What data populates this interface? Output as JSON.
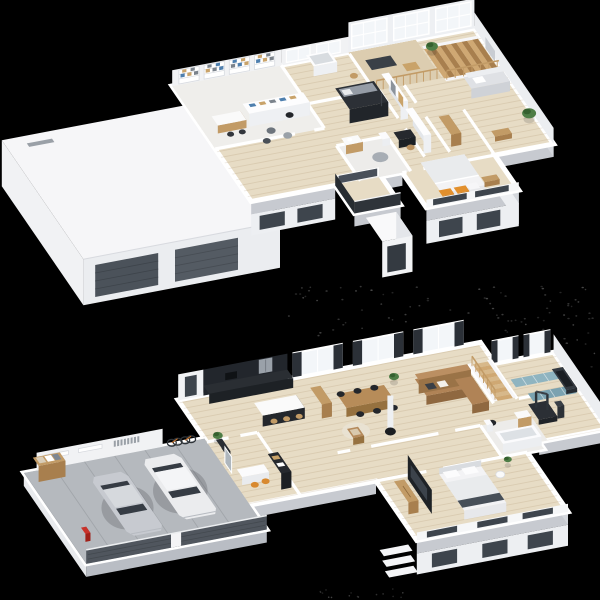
{
  "scene": {
    "title": "3D dollhouse floor plans of a two-storey house with garage, rendered on black",
    "background": "#000000",
    "floors": [
      {
        "name": "upper-floor",
        "rooms": [
          "library-playroom",
          "nursery",
          "kids-bunk-room",
          "bathroom",
          "walk-in-closet",
          "mezzanine-corridor",
          "staircase",
          "landing-lounge",
          "master-bedroom",
          "balcony"
        ],
        "exterior": [
          "garage-flat-roof",
          "double-height-window-wall",
          "porch-below"
        ],
        "objects": [
          "wall-bookshelves",
          "shelf-island",
          "play-desk",
          "floor-poufs",
          "bunk-bed",
          "crib",
          "vanity",
          "round-rug",
          "wardrobes",
          "double-bed-orange-pillows",
          "dresser",
          "grey-sofa",
          "potted-plants",
          "wood-railing",
          "wood-stairs",
          "dark-balcony-railing"
        ]
      },
      {
        "name": "ground-floor",
        "rooms": [
          "garage",
          "entry-hall",
          "home-office-nook",
          "kitchen",
          "dining-area",
          "living-room",
          "staircase",
          "home-gym",
          "bathroom",
          "bedroom"
        ],
        "objects": [
          "white-suv",
          "silver-car",
          "storage-shelf-boxes",
          "wall-bikes",
          "red-vacuum",
          "black-kitchen-wall",
          "kitchen-island-stools",
          "wood-shelf",
          "dining-table-six-black-chairs",
          "armchair",
          "round-rug",
          "white-stove-pipe",
          "caramel-corner-sofa",
          "wood-stairs",
          "exercise-machine",
          "treadmill",
          "blue-gym-mats",
          "bathtub",
          "vanity",
          "double-bed",
          "wood-dresser",
          "dark-tv-panel",
          "porch-steps"
        ]
      }
    ],
    "palette": {
      "bg": "#000000",
      "dot": "#4c4c4c",
      "roofTop": "#f6f6f8",
      "wallWhite": "#ffffff",
      "wallFace": "#f1f2f4",
      "wallShade": "#e2e4e8",
      "slabEdge": "#c7cad0",
      "underWall": "#edeff2",
      "sideFace": "#eceef1",
      "glassDark": "#3e454d",
      "glassPane": "#f3f6f9",
      "curtain": "#2b3037",
      "garageDoorA": "#4b525a",
      "garageDoorB": "#545b63",
      "garageFloor": "#b5b9be",
      "floorWood": "#e7dcc5",
      "floorVoid": "#dccdb0",
      "libFloor": "#efeeeb",
      "tile": "#edecea",
      "plank": "rgba(150,118,74,0.16)",
      "wood": "#c29b66",
      "woodDark": "#a87f4e",
      "woodLight": "#d7b88a",
      "black": "#1d2126",
      "blackSoft": "#2c3036",
      "steel": "#9aa1a9",
      "sofaA": "#b08356",
      "sofaB": "#8f6840",
      "sofaC": "#7d5a36",
      "chairDark": "#23262b",
      "greySofa": "#dfe1e5",
      "bedTop": "#f3f3f5",
      "bedBlanket": "#e9ebed",
      "bedThrow": "#474f58",
      "pillowOrange": "#e2902e",
      "matA": "#8fb4c0",
      "matB": "#7aa2b0",
      "plantA": "#4e7d46",
      "plantB": "#35602f",
      "rug": "#a7adb4",
      "railDark": "#2f343a",
      "carWhite": "#ebecee",
      "carSilver": "#c7cad0",
      "carGlass": "#363c44",
      "red": "#c8322a",
      "orangeChair": "#d8892f",
      "bookBlue": "#4e7fae",
      "bookTan": "#c9a36a",
      "bookGrey": "#7b838c"
    }
  }
}
